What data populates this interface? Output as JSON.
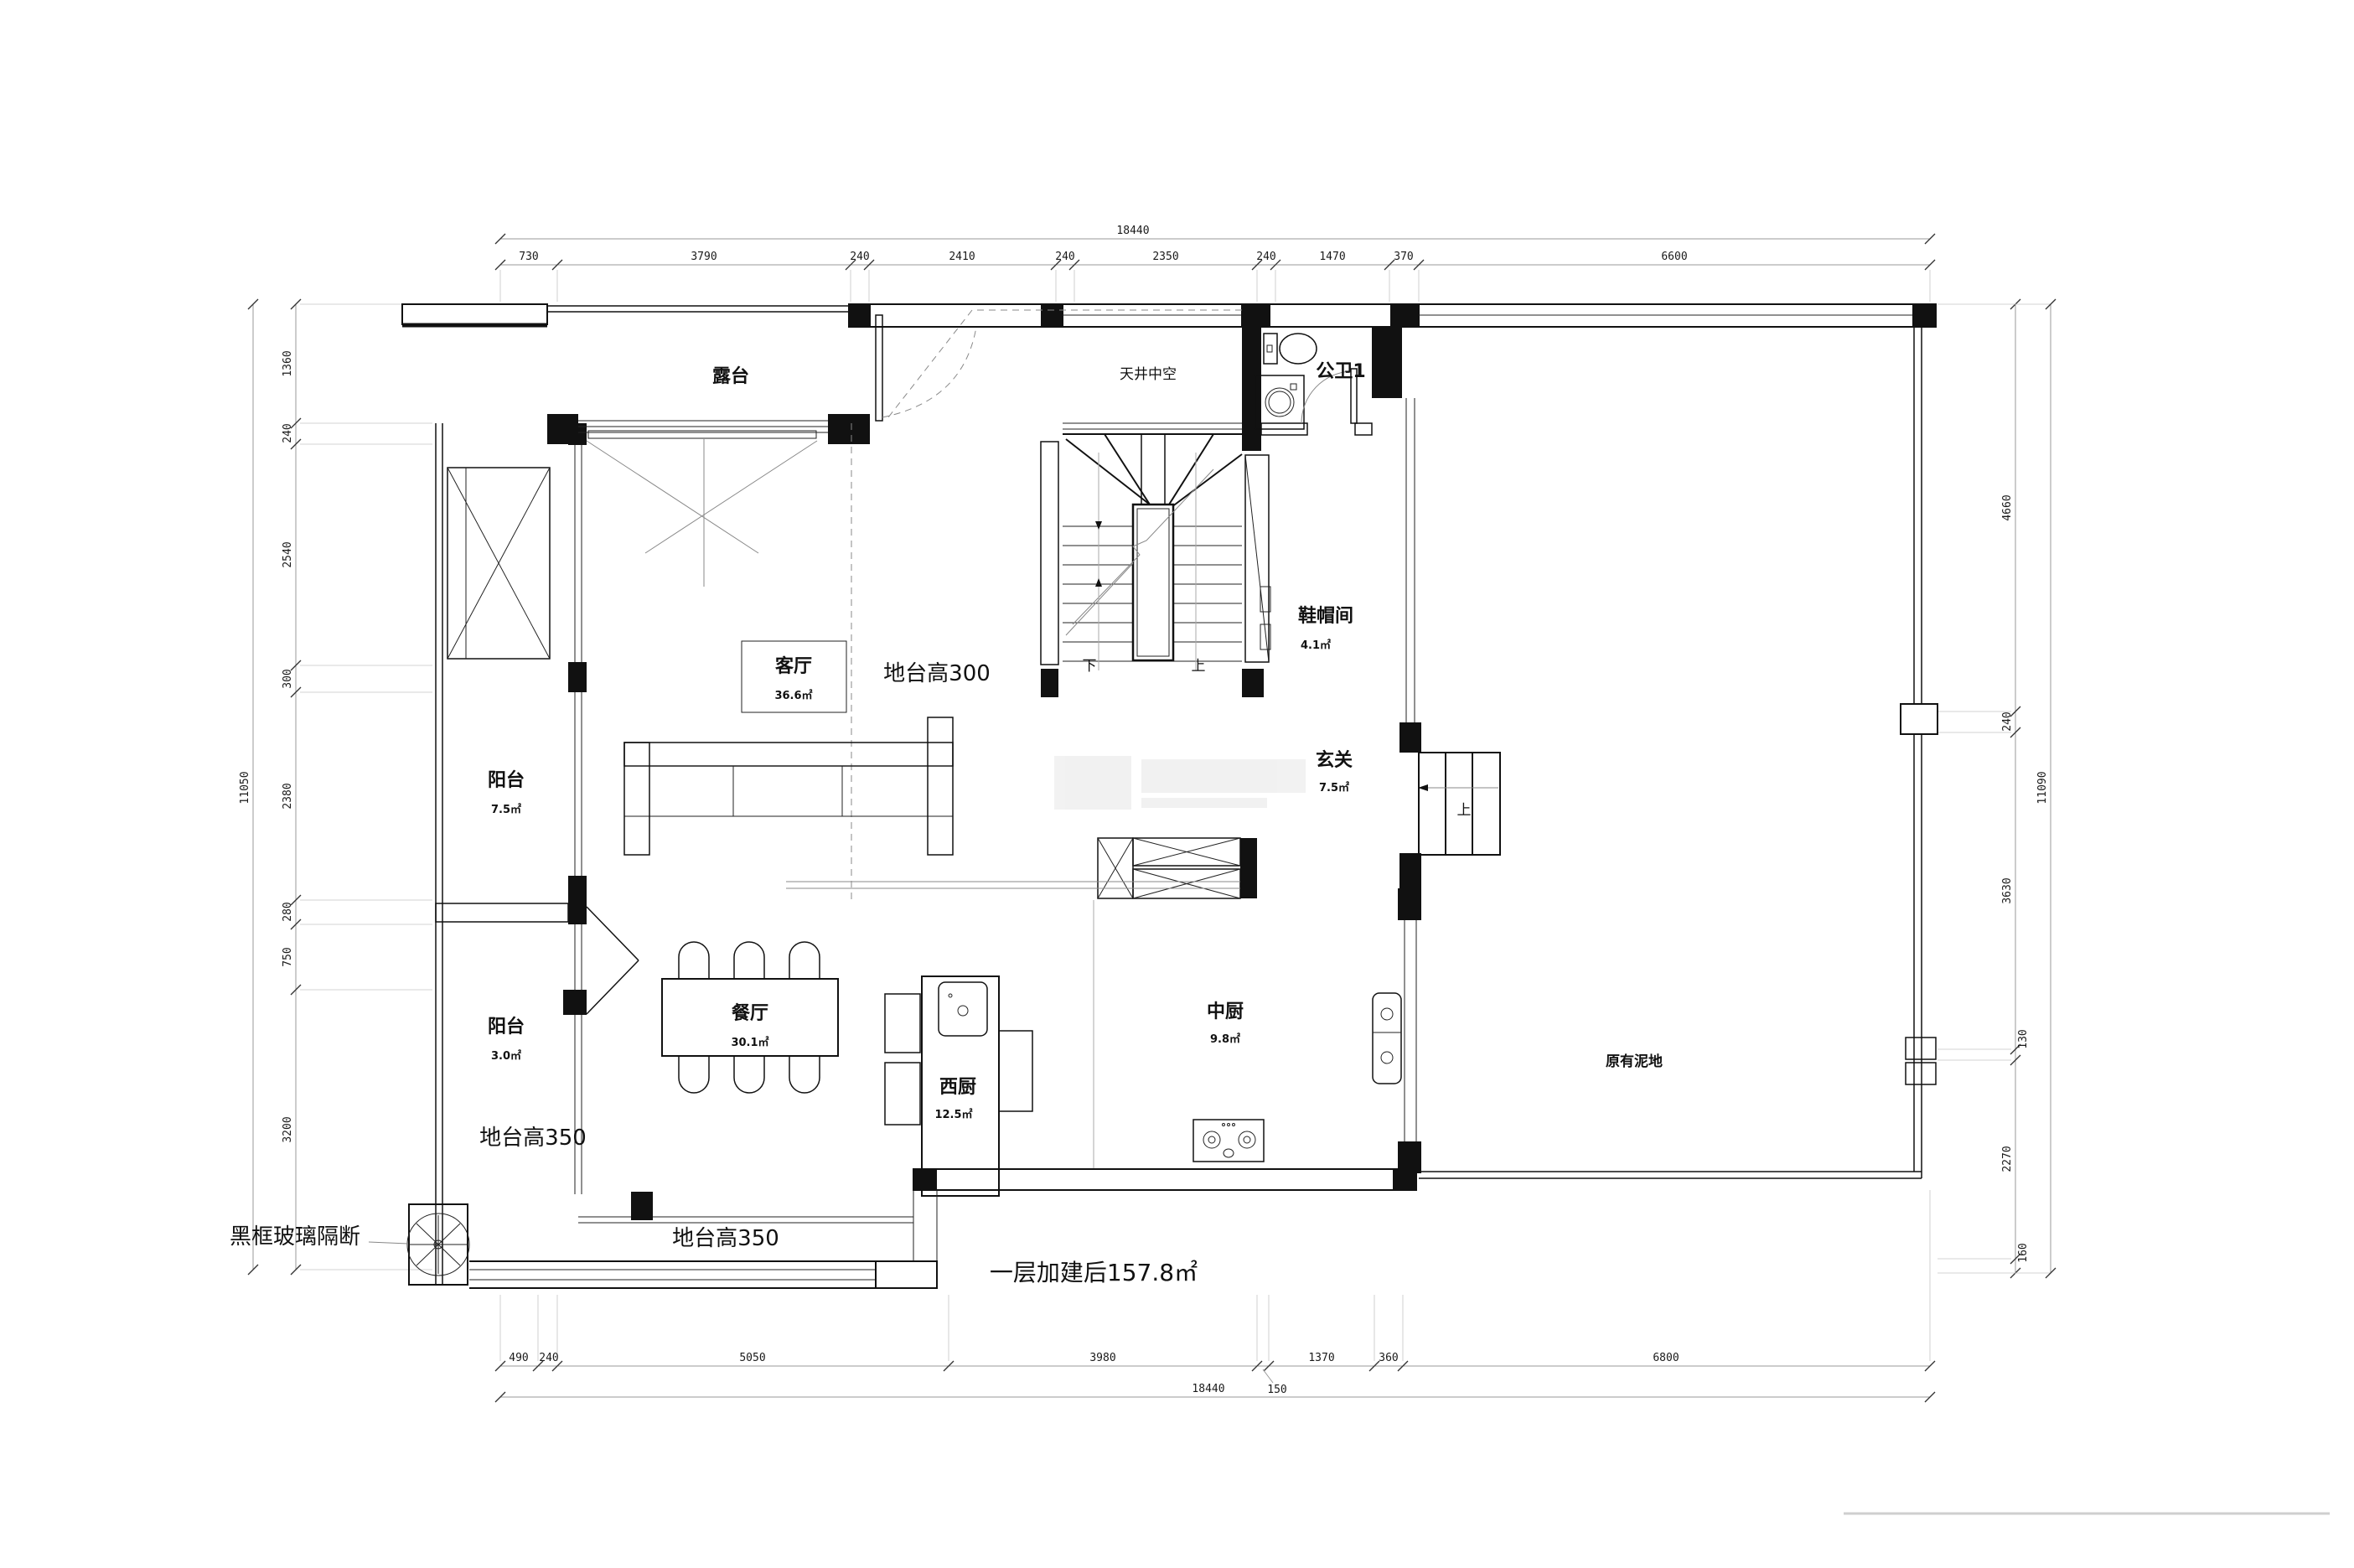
{
  "drawing": {
    "type": "residential floor plan",
    "floor_note": "一层加建后157.8㎡"
  },
  "rooms": {
    "terrace": {
      "name": "露台",
      "area": ""
    },
    "void": {
      "name": "天井中空",
      "area": ""
    },
    "bath": {
      "name": "公卫1",
      "area": ""
    },
    "cloak": {
      "name": "鞋帽间",
      "area": "4.1㎡"
    },
    "living": {
      "name": "客厅",
      "area": "36.6㎡"
    },
    "balcony_upper": {
      "name": "阳台",
      "area": "7.5㎡"
    },
    "balcony_lower": {
      "name": "阳台",
      "area": "3.0㎡"
    },
    "dining": {
      "name": "餐厅",
      "area": "30.1㎡"
    },
    "west_kitchen": {
      "name": "西厨",
      "area": "12.5㎡"
    },
    "chinese_kitchen": {
      "name": "中厨",
      "area": "9.8㎡"
    },
    "foyer": {
      "name": "玄关",
      "area": "7.5㎡"
    },
    "ground": {
      "name": "原有泥地",
      "area": ""
    }
  },
  "annotations": {
    "platform300": "地台高300",
    "platform350_left": "地台高350",
    "platform350_bottom": "地台高350",
    "glass_partition": "黑框玻璃隔断",
    "floor_total": "一层加建后157.8㎡",
    "stair_down": "下",
    "stair_up": "上",
    "entry_up": "上"
  },
  "dims": {
    "top": {
      "total": "18440",
      "segs": [
        "730",
        "3790",
        "240",
        "2410",
        "240",
        "2350",
        "240",
        "1470",
        "370",
        "6600"
      ]
    },
    "bottom": {
      "total": "18440",
      "segs": [
        "490",
        "240",
        "5050",
        "3980",
        "150",
        "1370",
        "360",
        "6800"
      ]
    },
    "left": {
      "total": "11050",
      "segs": [
        "1360",
        "240",
        "2540",
        "300",
        "2380",
        "280",
        "750",
        "3200"
      ]
    },
    "right": {
      "total": "11090",
      "segs": [
        "4660",
        "240",
        "3630",
        "130",
        "2270",
        "160"
      ]
    }
  },
  "colors": {
    "wall": "#111111",
    "dim_line": "#9a9a9a",
    "dim_text": "#1a1a1a",
    "background": "#ffffff",
    "light_detail": "#888888",
    "watermark": "#ececec"
  }
}
